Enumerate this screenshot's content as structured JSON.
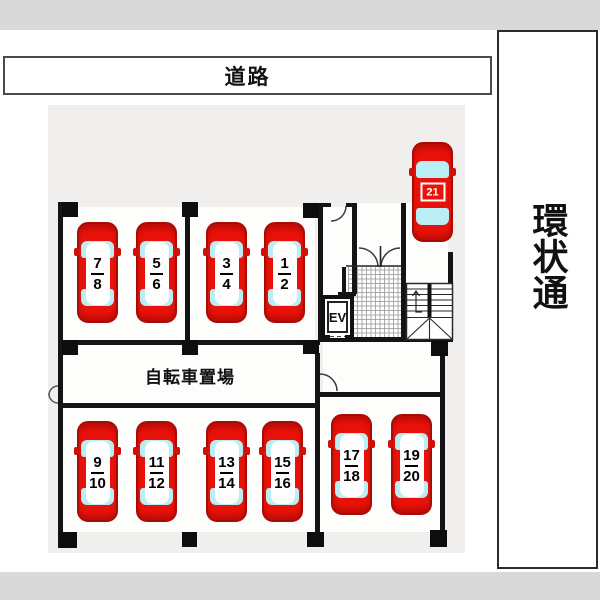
{
  "top_road": {
    "label": "道路"
  },
  "right_road": {
    "label": "環状通"
  },
  "bicycle_area": {
    "label": "自転車置場"
  },
  "elevator": {
    "label": "EV"
  },
  "parking_spaces": [
    {
      "name": "space-7-8",
      "top": "7",
      "bottom": "8"
    },
    {
      "name": "space-5-6",
      "top": "5",
      "bottom": "6"
    },
    {
      "name": "space-3-4",
      "top": "3",
      "bottom": "4"
    },
    {
      "name": "space-1-2",
      "top": "1",
      "bottom": "2"
    },
    {
      "name": "space-9-10",
      "top": "9",
      "bottom": "10"
    },
    {
      "name": "space-11-12",
      "top": "11",
      "bottom": "12"
    },
    {
      "name": "space-13-14",
      "top": "13",
      "bottom": "14"
    },
    {
      "name": "space-15-16",
      "top": "15",
      "bottom": "16"
    },
    {
      "name": "space-17-18",
      "top": "17",
      "bottom": "18"
    },
    {
      "name": "space-19-20",
      "top": "19",
      "bottom": "20"
    },
    {
      "name": "space-21",
      "label": "21"
    }
  ],
  "colors": {
    "car_red": "#e8120a",
    "car_outline": "#a80c06",
    "window_cyan": "#b9eef5",
    "wall_black": "#141414",
    "floor_gray": "#f1efed",
    "letterbox_gray": "#d9d9d9"
  }
}
